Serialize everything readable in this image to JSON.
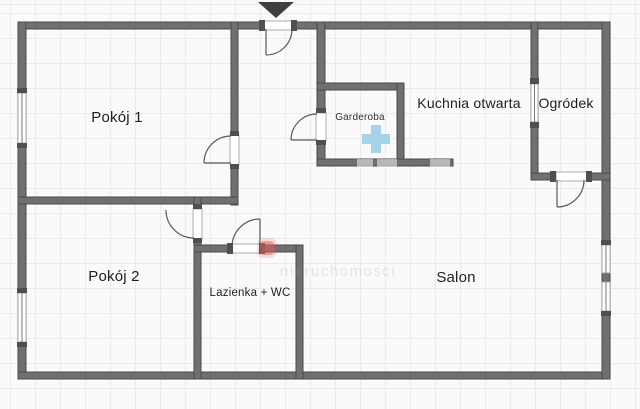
{
  "plan": {
    "rooms": [
      {
        "id": "pokoj-1",
        "label": "Pokój 1"
      },
      {
        "id": "pokoj-2",
        "label": "Pokój 2"
      },
      {
        "id": "garderoba",
        "label": "Garderoba"
      },
      {
        "id": "kuchnia",
        "label": "Kuchnia otwarta"
      },
      {
        "id": "ogrodek",
        "label": "Ogródek"
      },
      {
        "id": "lazienka",
        "label": "Lazienka + WC"
      },
      {
        "id": "salon",
        "label": "Salon"
      }
    ],
    "icons": [
      {
        "name": "entrance-arrow-icon",
        "color": "#3f3f3f"
      },
      {
        "name": "medical-plus-icon",
        "color": "#a6d3ec"
      }
    ],
    "watermark": {
      "text": "nieruchomosci",
      "square_color": "#e05c5c"
    },
    "colors": {
      "wall": "#707070",
      "wall_edge": "#4a4a4a",
      "jamb": "#4f4f4f",
      "grid_line": "#ebebe9",
      "background": "#fbfafa"
    }
  }
}
